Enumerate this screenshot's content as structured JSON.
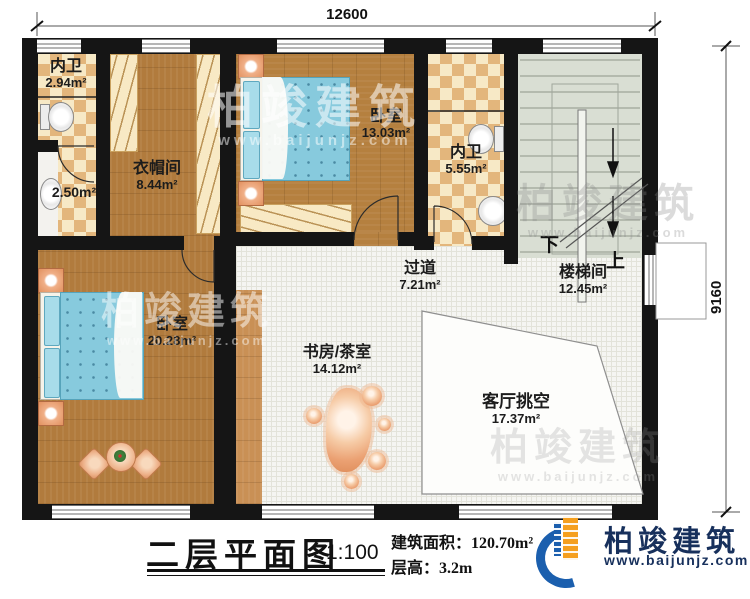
{
  "title_block": {
    "title": "二层平面图",
    "scale": "1:100",
    "building_area": "建筑面积：120.70m²",
    "floor_height": "层高：3.2m"
  },
  "dimensions": {
    "top": "12600",
    "right": "9160"
  },
  "rooms": [
    {
      "name": "内卫",
      "area": "2.94m²"
    },
    {
      "name": "",
      "area": "2.50m²"
    },
    {
      "name": "衣帽间",
      "area": "8.44m²"
    },
    {
      "name": "卧室",
      "area": "13.03m²"
    },
    {
      "name": "内卫",
      "area": "5.55m²"
    },
    {
      "name": "楼梯间",
      "area": "12.45m²"
    },
    {
      "name": "过道",
      "area": "7.21m²"
    },
    {
      "name": "卧室",
      "area": "20.28m²"
    },
    {
      "name": "书房/茶室",
      "area": "14.12m²"
    },
    {
      "name": "客厅挑空",
      "area": "17.37m²"
    }
  ],
  "stairs": {
    "down": "下",
    "up": "上"
  },
  "brand": {
    "name": "柏竣建筑",
    "website": "www.baijunjz.com"
  },
  "watermark": {
    "name": "柏竣建筑",
    "website": "www.baijunjz.com"
  },
  "colors": {
    "wall": "#151515",
    "wood": "#b17b3d",
    "tile_light": "#f7e9c6",
    "tile_dark": "#e3b67c",
    "corridor_tile": "#f5f5f2",
    "stair": "#d9ded3",
    "bed": "#87cadd",
    "brand_orange": "#f59f1e",
    "brand_blue": "#1b5fae",
    "brand_navy": "#17305c"
  }
}
